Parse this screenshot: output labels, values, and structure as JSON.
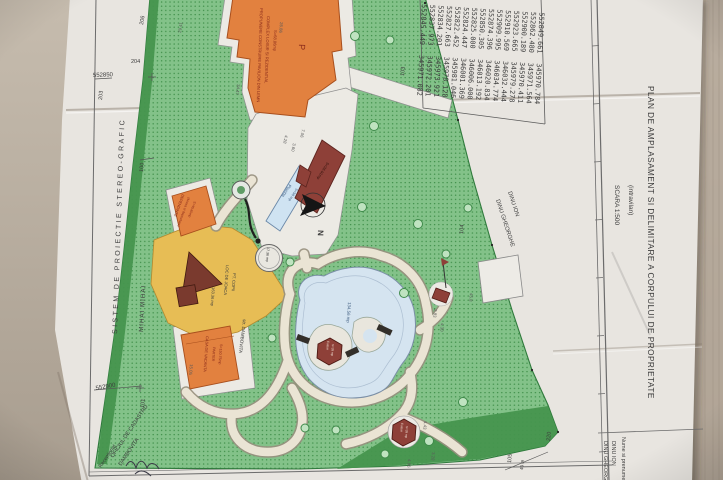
{
  "colors": {
    "background": "#b9ae9f",
    "paper": "#e8e5e0",
    "green": "#83c289",
    "green_dark": "#46954e",
    "orange_building": "#e2813f",
    "yellow_area": "#e7bd55",
    "red_building": "#8e4038",
    "pond": "#d5e4f0",
    "pool": "#cfe3f2",
    "walkway": "#eae4d4"
  },
  "title_block": {
    "title": "PLAN DE AMPLASAMENT SI DELIMITARE A CORPULUI DE PROPRIETATE",
    "subtitle": "(intravilan)",
    "scale": "SCARA 1:500",
    "name_label": "Nume si prenume:",
    "owner1": "DINU ION",
    "owner2": "DINU GHEORGHE"
  },
  "margin": {
    "projection": "SISTEM DE PROIECTIE STEREO-GRAFIC",
    "office_line1": "OFICIUL DE CADASTRU",
    "office_line2": "DAMBOVITA",
    "received": "Receptionat",
    "neighbor_west": "MIHAI MIHAI",
    "neighbor_east1": "DINU ION",
    "neighbor_east2": "DINU GHEORGHE",
    "street": "str. DAMBOVITA"
  },
  "grid": {
    "northing_a": "552850",
    "northing_b": "552900"
  },
  "parcels": {
    "p206": "206",
    "p204": "204",
    "p203": "203",
    "p100": "100",
    "p101": "101",
    "p103": "103",
    "p104": "104",
    "p105": "105",
    "p220": "220",
    "dist": "40 m"
  },
  "north": "N",
  "features": {
    "pavilion": {
      "l1": "PROPUNERE CONSTRUIRE PAVILION DIN LEMN",
      "l2": "COMPLEX LOISIR SI REZIDENTIAL",
      "l3": "S=68.86mp",
      "storey": "P"
    },
    "dependinte": {
      "l1": "DEPENDINTE",
      "l2": "(Anexa si depozitare)",
      "l3": "S=45.80mp"
    },
    "pool": {
      "l1": "Piscina",
      "l2": "S=58 mp"
    },
    "spa": {
      "area": "S=36.91mp"
    },
    "casa": {
      "l1": "CASA DE VACANTA",
      "l2": "PARTER",
      "l3": "S=150.75mp"
    },
    "playground": {
      "l1": "LOC DE JOACA",
      "l2": "PT. COPII",
      "area": "163.36 mp"
    },
    "gazebo": {
      "area": "17.36 mp"
    },
    "pond": {
      "area": "134.56 mp"
    },
    "foisor1": {
      "l1": "Foisor",
      "l2": "S=28 mp"
    },
    "foisor2": {
      "l1": "Foisor",
      "l2": "S=28 mp"
    }
  },
  "dimensions": [
    "26.86",
    "34.47",
    "4.28",
    "3.60",
    "7.06",
    "29.41",
    "15.05",
    "4.43",
    "3.28",
    "4.96",
    "2.83",
    "4.30",
    "45.8"
  ],
  "coordinate_table": {
    "rows": [
      {
        "x": "552845.449",
        "y": "345971.082"
      },
      {
        "x": "552837.973",
        "y": "345972.201"
      },
      {
        "x": "552834.201",
        "y": "345973.921"
      },
      {
        "x": "552827.663",
        "y": "345978.128"
      },
      {
        "x": "552822.452",
        "y": "345981.046"
      },
      {
        "x": "552824.447",
        "y": "346001.369"
      },
      {
        "x": "552825.000",
        "y": "346006.000"
      },
      {
        "x": "552850.305",
        "y": "346013.192"
      },
      {
        "x": "552874.396",
        "y": "346020.834"
      },
      {
        "x": "552909.995",
        "y": "346034.774"
      },
      {
        "x": "552910.569",
        "y": "346032.444"
      },
      {
        "x": "552923.665",
        "y": "345979.278"
      },
      {
        "x": "552900.189",
        "y": "345970.411"
      },
      {
        "x": "552862.480",
        "y": "345971.564"
      },
      {
        "x": "552849.661",
        "y": "345970.784"
      }
    ]
  }
}
